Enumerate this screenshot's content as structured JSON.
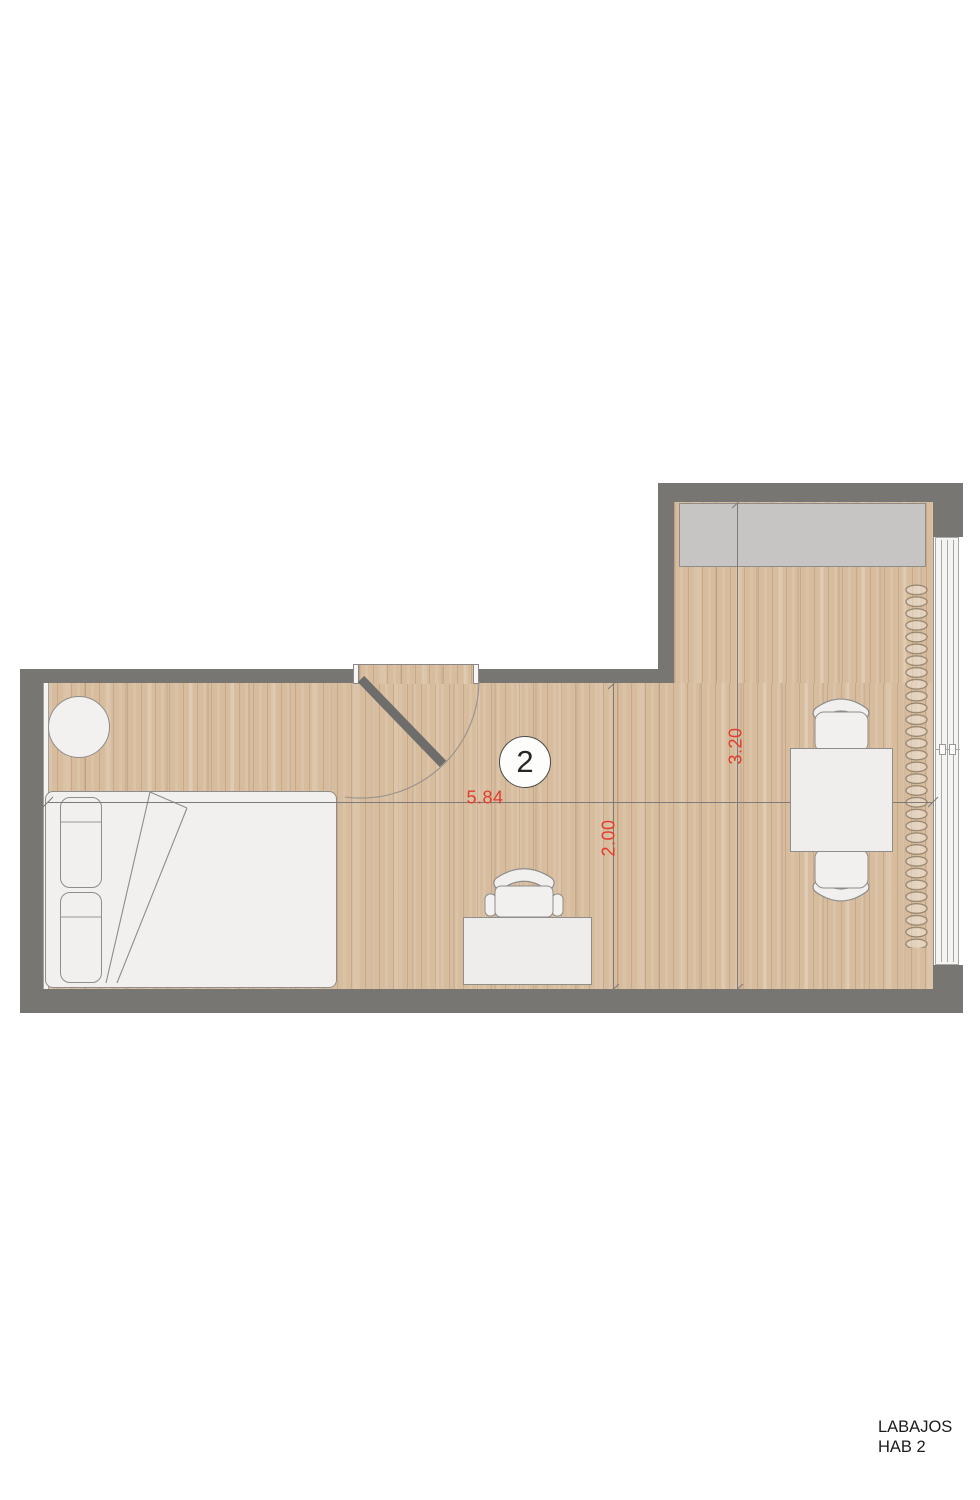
{
  "room": {
    "number": "2"
  },
  "dimensions": {
    "width_m": "5.84",
    "depth_left_m": "2.00",
    "depth_right_m": "3.20"
  },
  "title_block": {
    "line1": "LABAJOS",
    "line2": "HAB 2"
  },
  "colors": {
    "dimension_red": "#e23d2e",
    "wall_gray": "#787673",
    "door_leaf_gray": "#6e6d6b",
    "floor_tan": "#d7bc9e",
    "wardrobe_gray": "#c7c5c3",
    "furniture_white": "#f1f0ee",
    "furniture_outline": "#8f8d89",
    "window_white": "#f4f4f3",
    "window_line": "#aaa8a4",
    "curtain_brown": "#93826c",
    "dimension_line_gray": "#7d7b79",
    "text_black": "#1b1b1a"
  }
}
